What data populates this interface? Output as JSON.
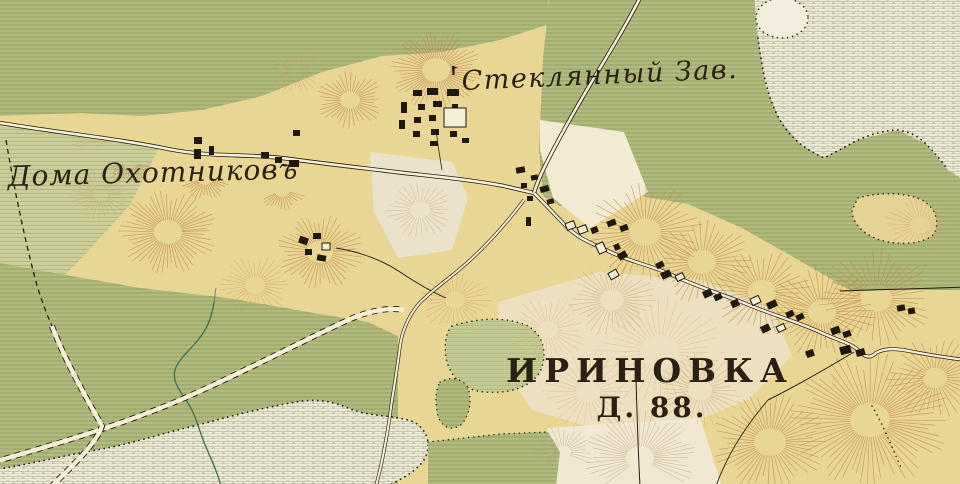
{
  "map": {
    "labels": {
      "glass_factory": "Стеклянный Зав.",
      "hunters_houses": "Дома Охотниковъ",
      "village_name": "ИРИНОВКА",
      "village_households": "Д. 88."
    },
    "colors": {
      "field_yellow": "#e8d695",
      "meadow_green": "#b7bd80",
      "meadow_line": "#84955a",
      "marsh_white": "#f1ecdc",
      "hachure_orange": "#bf8445",
      "road_fill": "#f6efd8",
      "ink_black": "#241d12",
      "stream_green": "#3e7054"
    }
  }
}
